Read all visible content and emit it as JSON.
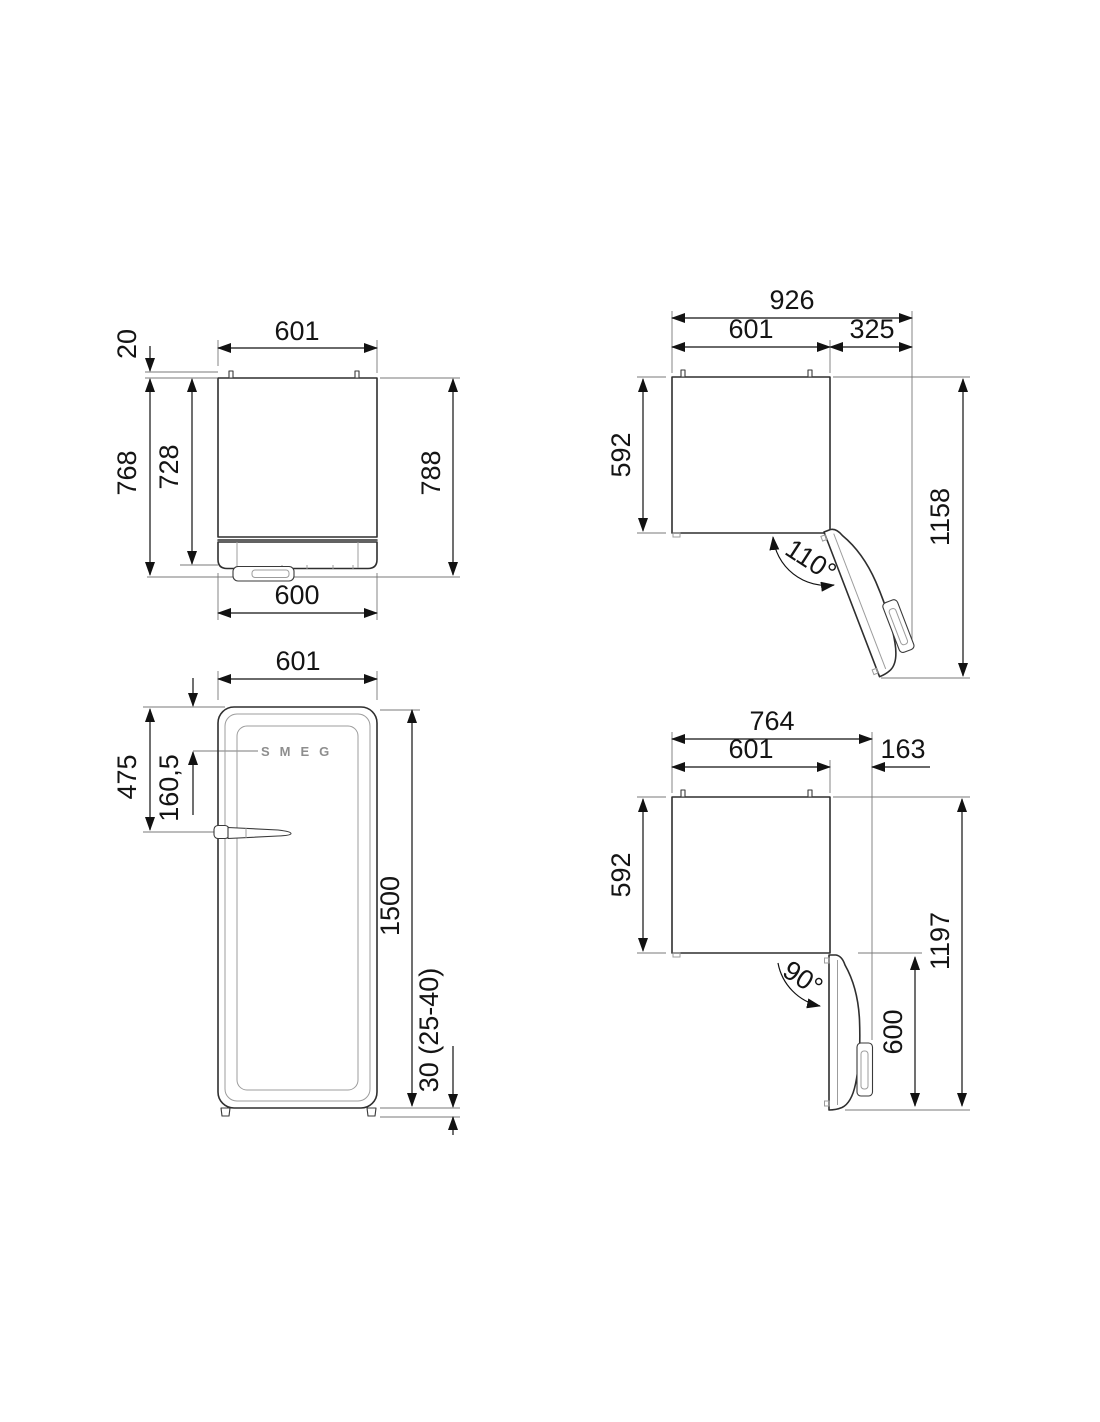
{
  "page": {
    "background": "#ffffff",
    "line_color": "#2f2f2f"
  },
  "views": {
    "top_closed": {
      "dims": {
        "width_top": "601",
        "rear_gap": "20",
        "depth_no_handle": "768",
        "depth_body": "728",
        "depth_overall": "788",
        "width_door": "600"
      }
    },
    "top_open_110": {
      "dims": {
        "width_overall": "926",
        "width_body": "601",
        "side_extra": "325",
        "depth_body": "592",
        "depth_overall": "1158",
        "door_angle": "110°"
      }
    },
    "front": {
      "logo": "SMEG",
      "dims": {
        "width": "601",
        "top_to_handle": "475",
        "top_to_logo": "160,5",
        "height": "1500",
        "feet_height": "30 (25-40)"
      }
    },
    "top_open_90": {
      "dims": {
        "width_overall": "764",
        "width_body": "601",
        "handle_projection": "163",
        "depth_body": "592",
        "depth_overall": "1197",
        "door_width": "600",
        "door_angle": "90°"
      }
    }
  }
}
